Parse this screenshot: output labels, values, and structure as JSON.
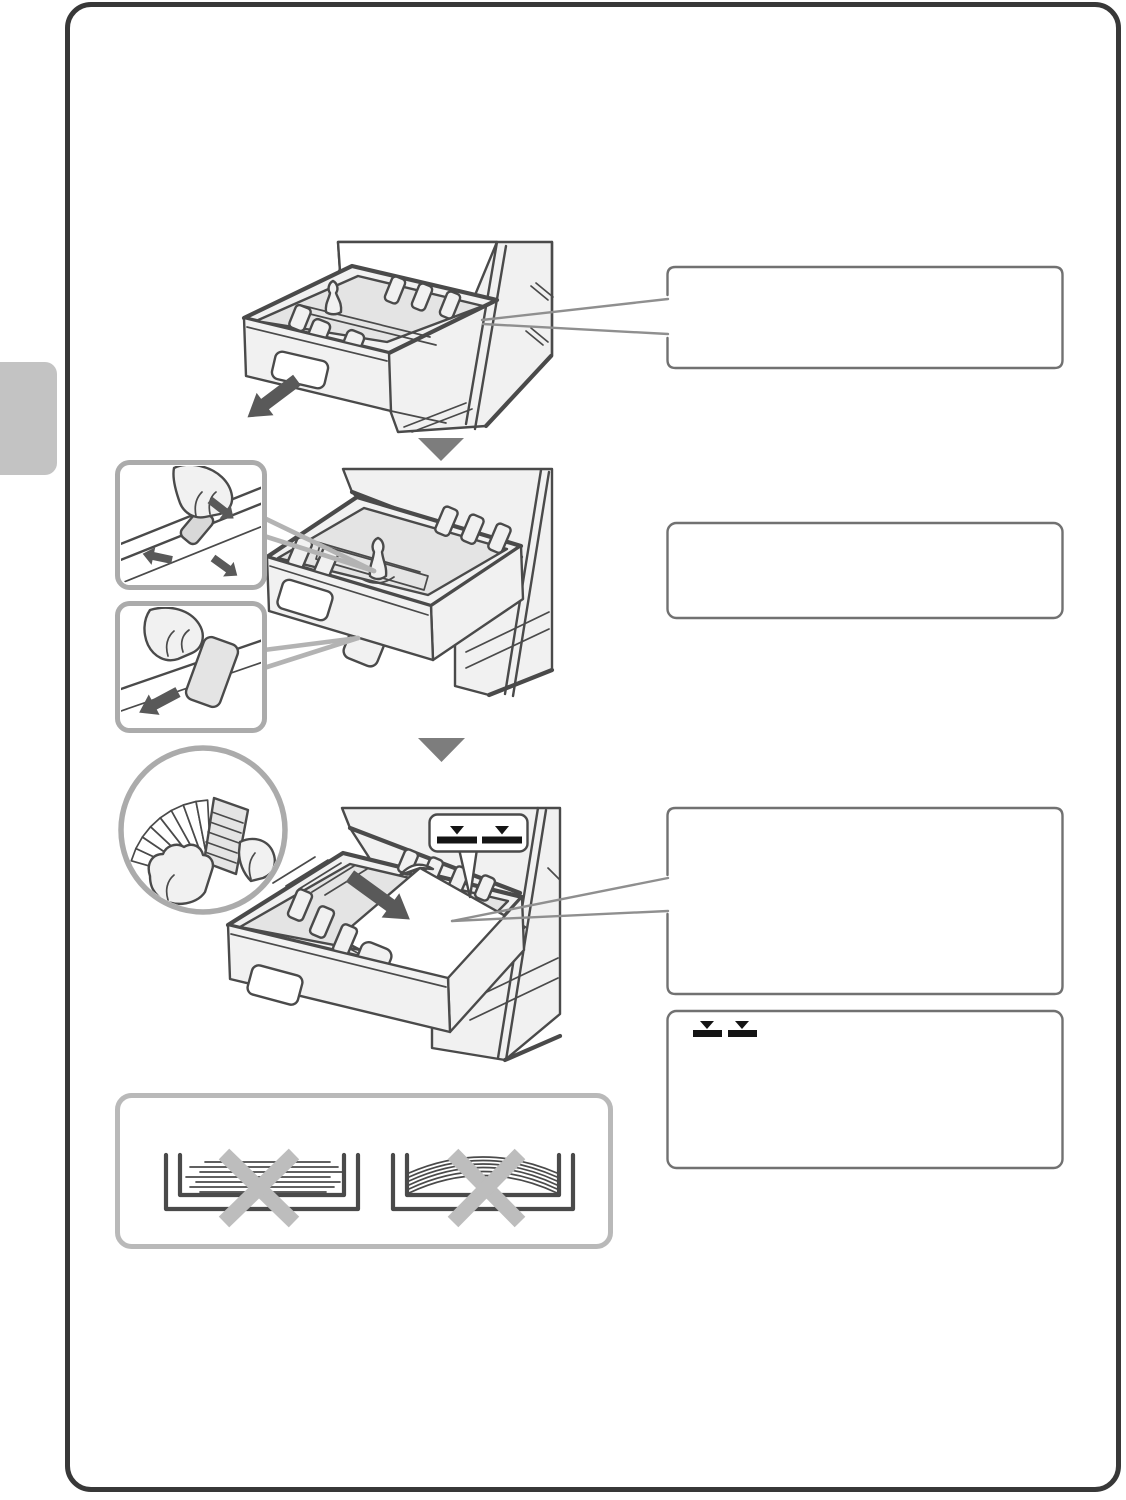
{
  "document": {
    "type": "printer-manual-illustration-page",
    "visible_text": ""
  },
  "colors": {
    "page_background": "#ffffff",
    "page_border": "#383838",
    "side_tab": "#c3c3c3",
    "line_art": "#4a4a4a",
    "fill_light": "#f1f1f1",
    "fill_mid": "#e4e4e4",
    "fill_dark": "#d8d8d8",
    "callout_border": "#717171",
    "inset_border": "#ababab",
    "leader_line": "#8f8f8f",
    "wedge_line": "#b3b3b3",
    "step_triangle": "#7d7d7d",
    "arrow_dark": "#595959",
    "indicator_black": "#141414",
    "x_mark": "#bdbdbd",
    "dont_box_border": "#b9b9b9"
  },
  "side_tab": {
    "label": ""
  },
  "steps": [
    {
      "id": 1,
      "illustration": "paper-tray-pulled-out-of-machine",
      "arrow_icon": "thick-arrow-down-left",
      "callout": {
        "text": ""
      }
    },
    {
      "id": 2,
      "illustration": "adjusting-paper-guides",
      "insets": [
        "hand-pinching-side-guide",
        "hand-moving-front-guide"
      ],
      "callout": {
        "text": ""
      }
    },
    {
      "id": 3,
      "illustration": "loading-fanned-paper-into-tray",
      "insets": [
        "hands-fanning-paper-stack"
      ],
      "arrow_icon": "thick-arrow-down-right",
      "balloon_icon": "paper-limit-indicator",
      "callout": {
        "text": ""
      }
    }
  ],
  "note_box": {
    "indicator_icon": "paper-limit-indicator",
    "text": ""
  },
  "dont_box": {
    "icons": [
      "uneven-paper-stack-crossed-out",
      "curled-paper-stack-crossed-out"
    ]
  },
  "icons": {
    "step_separator": "down-triangle",
    "limit_indicator": "two-black-bars-with-down-triangles",
    "prohibited": "gray-x-mark"
  }
}
